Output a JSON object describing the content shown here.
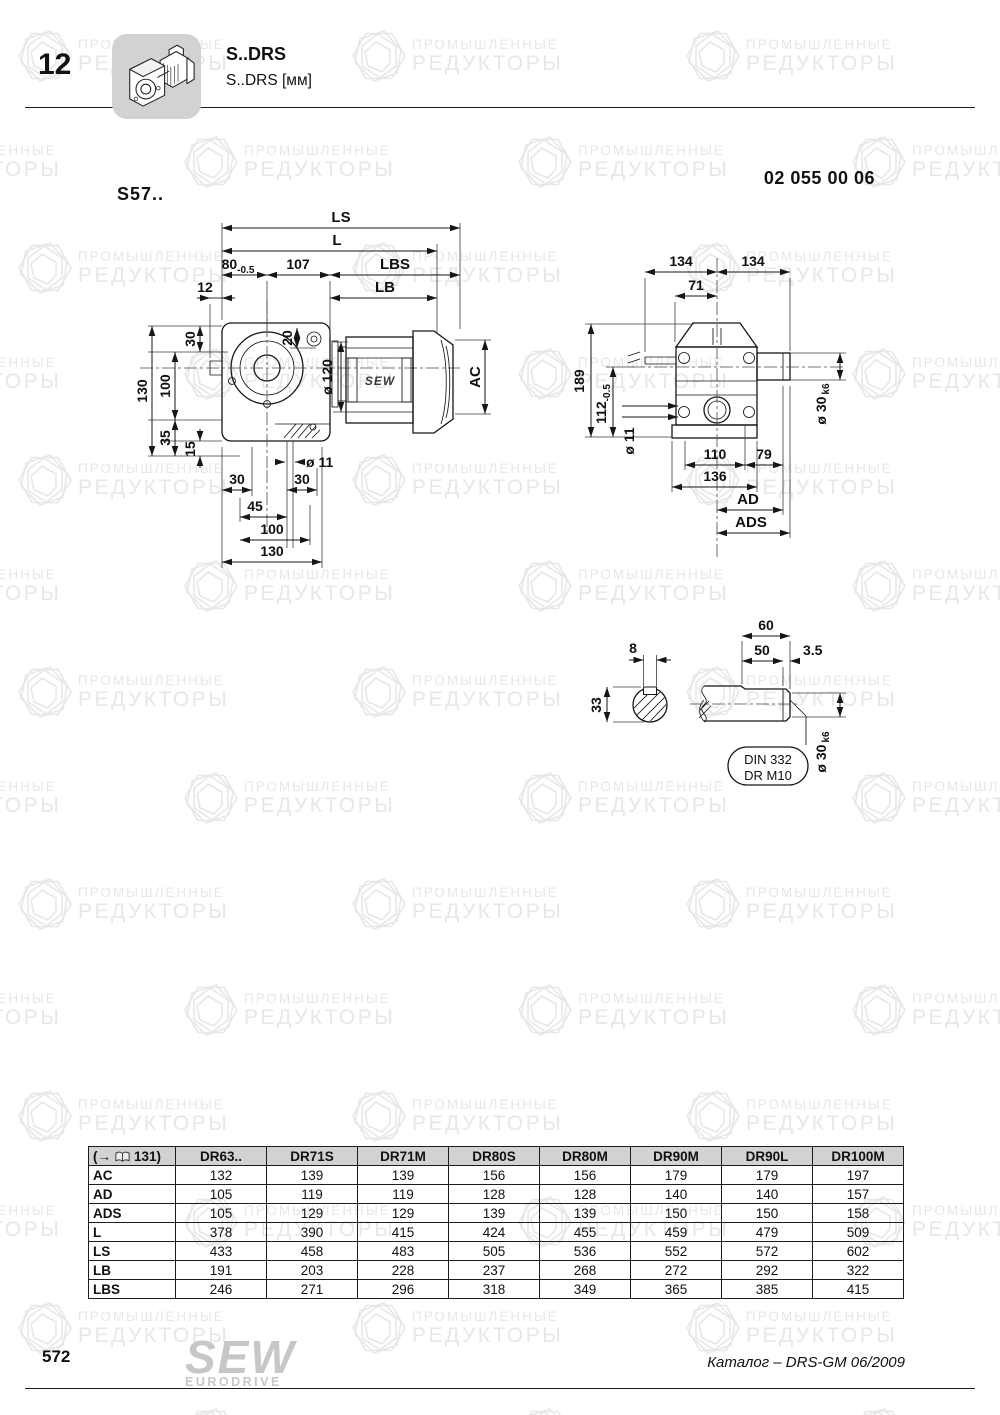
{
  "watermark": {
    "line1": "ПРОМЫШЛЕННЫЕ",
    "line2": "РЕДУКТОРЫ"
  },
  "header": {
    "chapter": "12",
    "title": "S..DRS",
    "subtitle": "S..DRS [мм]",
    "doc_number": "02 055 00 06",
    "series_label": "S57.."
  },
  "front_view": {
    "ls": "LS",
    "l": "L",
    "d80": "80",
    "d80_tol": "-0.5",
    "d107": "107",
    "lbs": "LBS",
    "d12": "12",
    "lb": "LB",
    "d30_top": "30",
    "d130_left": "130",
    "d100_left": "100",
    "d35": "35",
    "d15": "15",
    "d20": "20",
    "d120": "ø 120",
    "ac": "AC",
    "motor_brand": "SEW",
    "d11": "ø 11",
    "d30_bl": "30",
    "d30_br": "30",
    "d45": "45",
    "d100_bottom": "100",
    "d130_bottom": "130"
  },
  "side_view": {
    "d134_left": "134",
    "d134_right": "134",
    "d71": "71",
    "d189": "189",
    "d112": "112",
    "d112_tol": "-0.5",
    "d11": "ø 11",
    "d110": "110",
    "d79": "79",
    "d136": "136",
    "ad": "AD",
    "ads": "ADS",
    "d30": "ø 30",
    "d30_fit": "k6"
  },
  "shaft_detail": {
    "d8": "8",
    "d33": "33",
    "d60": "60",
    "d50": "50",
    "d3_5": "3.5",
    "d30": "ø 30",
    "d30_fit": "k6",
    "note_line1": "DIN 332",
    "note_line2": "DR M10"
  },
  "table": {
    "ref_prefix": "(→",
    "ref_page": "131)",
    "columns": [
      "DR63..",
      "DR71S",
      "DR71M",
      "DR80S",
      "DR80M",
      "DR90M",
      "DR90L",
      "DR100M"
    ],
    "rows": [
      {
        "label": "AC",
        "values": [
          "132",
          "139",
          "139",
          "156",
          "156",
          "179",
          "179",
          "197"
        ]
      },
      {
        "label": "AD",
        "values": [
          "105",
          "119",
          "119",
          "128",
          "128",
          "140",
          "140",
          "157"
        ]
      },
      {
        "label": "ADS",
        "values": [
          "105",
          "129",
          "129",
          "139",
          "139",
          "150",
          "150",
          "158"
        ]
      },
      {
        "label": "L",
        "values": [
          "378",
          "390",
          "415",
          "424",
          "455",
          "459",
          "479",
          "509"
        ]
      },
      {
        "label": "LS",
        "values": [
          "433",
          "458",
          "483",
          "505",
          "536",
          "552",
          "572",
          "602"
        ]
      },
      {
        "label": "LB",
        "values": [
          "191",
          "203",
          "228",
          "237",
          "268",
          "272",
          "292",
          "322"
        ]
      },
      {
        "label": "LBS",
        "values": [
          "246",
          "271",
          "296",
          "318",
          "349",
          "365",
          "385",
          "415"
        ]
      }
    ]
  },
  "footer": {
    "page_number": "572",
    "logo_top": "SEW",
    "logo_bottom": "EURODRIVE",
    "catalog_ref": "Каталог – DRS-GM 06/2009"
  }
}
